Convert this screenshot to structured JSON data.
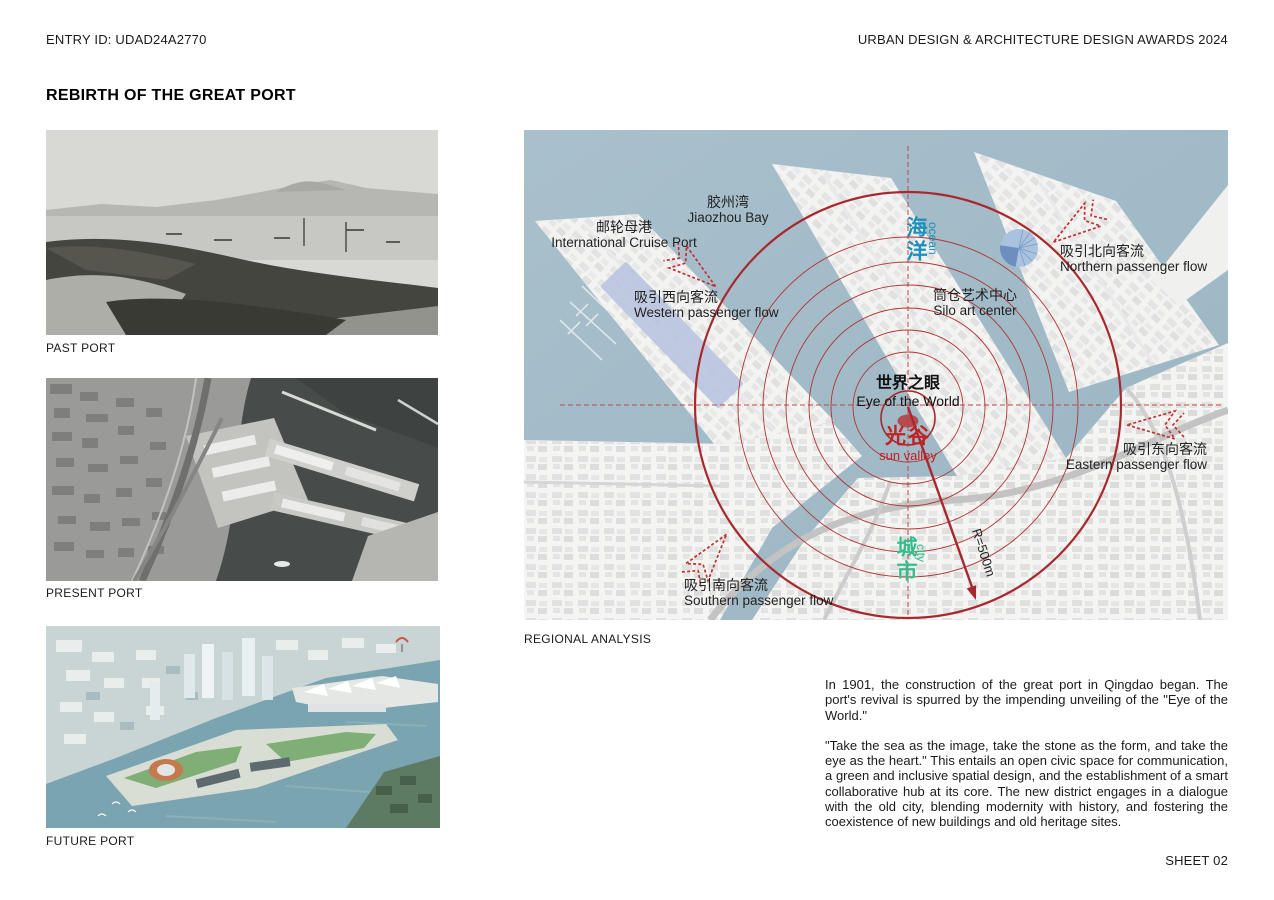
{
  "header": {
    "entry_id": "ENTRY ID: UDAD24A2770",
    "award": "URBAN DESIGN & ARCHITECTURE DESIGN AWARDS 2024"
  },
  "title": "REBIRTH OF THE GREAT PORT",
  "gallery": {
    "past": {
      "caption": "PAST PORT",
      "description": "historic black-and-white photograph of Jiaozhou Bay shoreline with boats"
    },
    "present": {
      "caption": "PRESENT PORT",
      "description": "black-and-white aerial photo of the industrial port, piers and highway"
    },
    "future": {
      "caption": "FUTURE PORT",
      "description": "color aerial rendering of the redeveloped port district with towers and green piers"
    }
  },
  "map": {
    "caption": "REGIONAL ANALYSIS",
    "labels": {
      "bay": {
        "zh": "胶州湾",
        "en": "Jiaozhou Bay"
      },
      "cruise": {
        "zh": "邮轮母港",
        "en": "International Cruise Port"
      },
      "west": {
        "zh": "吸引西向客流",
        "en": "Western passenger flow"
      },
      "north": {
        "zh": "吸引北向客流",
        "en": "Northern passenger flow"
      },
      "east": {
        "zh": "吸引东向客流",
        "en": "Eastern passenger flow"
      },
      "south": {
        "zh": "吸引南向客流",
        "en": "Southern passenger flow"
      },
      "silo": {
        "zh": "筒仓艺术中心",
        "en": "Silo art center"
      },
      "eye": {
        "zh": "世界之眼",
        "en": "Eye of the World"
      },
      "valley": {
        "zh": "光谷",
        "en": "sun valley"
      },
      "ocean": {
        "zh": "海洋",
        "en": "ocean"
      },
      "city": {
        "zh": "城市",
        "en": "city"
      },
      "radius": "R=500m"
    },
    "colors": {
      "water": "#a5bdca",
      "ring_red": "#a8292d",
      "arrow_red": "#c23131",
      "ocean_label": "#1d8fbc",
      "city_label": "#35bd8d",
      "valley_red": "#c32222",
      "silo_marker_blue": "#6d8fbf",
      "cruise_terminal_blue": "#b9c5e0"
    }
  },
  "description": {
    "para1": "In 1901, the construction of the great port in Qingdao began. The port's revival is spurred by the impending unveiling of the \"Eye of the World.\"",
    "para2": "\"Take the sea as the image, take the stone as the form, and take the eye as the heart.\" This entails an open civic space for communication, a green and inclusive spatial design, and the establishment of a smart collaborative hub at its core. The new district engages in a dialogue with the old city, blending modernity with history, and fostering the coexistence of new buildings and old heritage sites."
  },
  "footer": {
    "sheet": "SHEET 02"
  }
}
